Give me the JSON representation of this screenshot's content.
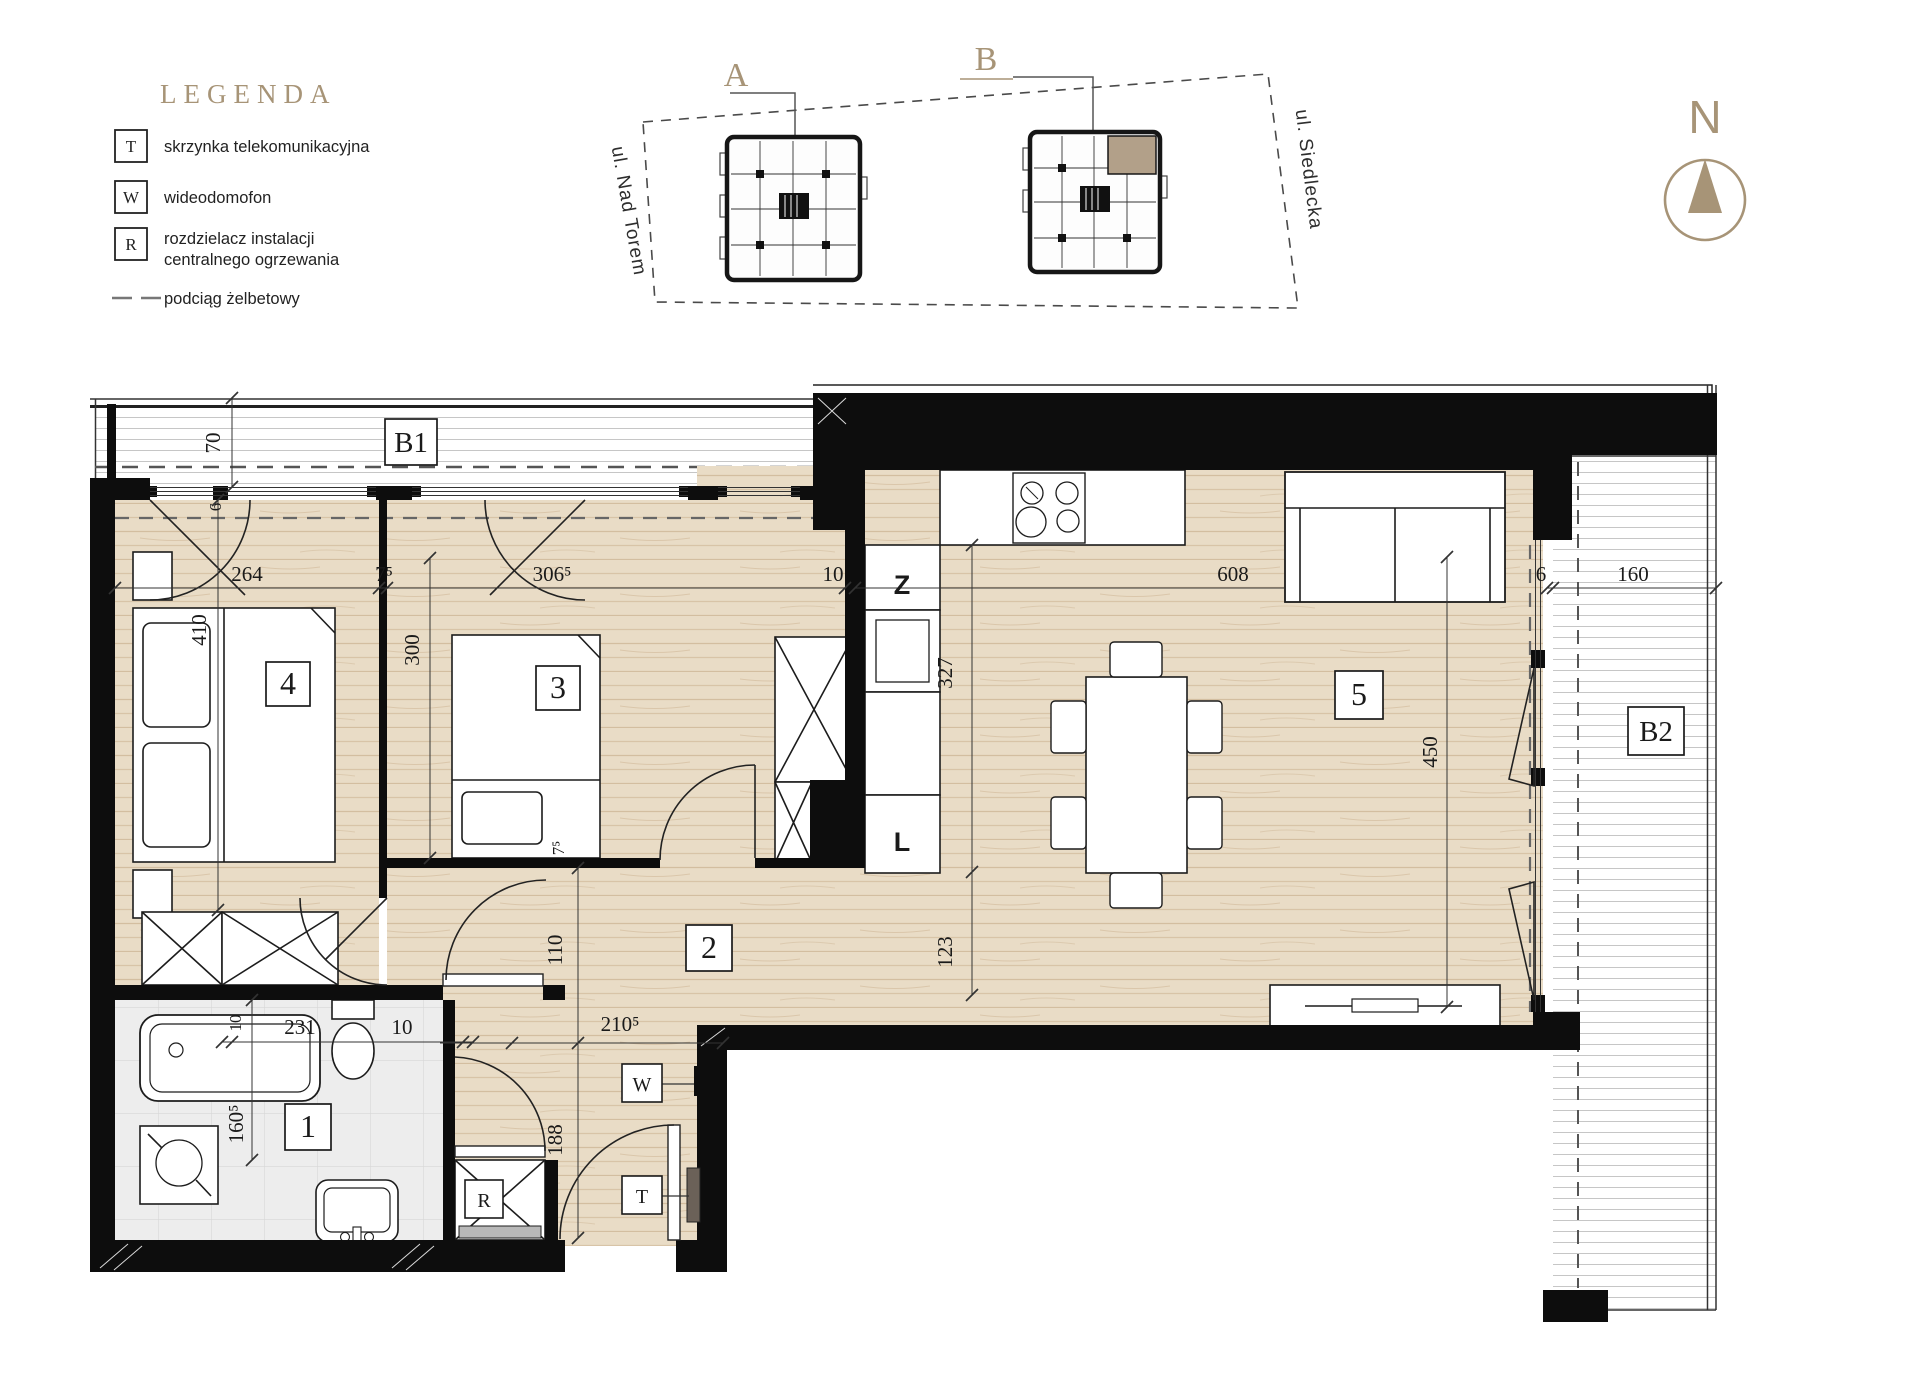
{
  "legend": {
    "title": "LEGENDA",
    "items": [
      {
        "symbol": "T",
        "label": "skrzynka telekomunikacyjna"
      },
      {
        "symbol": "W",
        "label": "wideodomofon"
      },
      {
        "symbol": "R",
        "label": "rozdzielacz instalacji",
        "label2": "centralnego ogrzewania"
      },
      {
        "symbol": "dashed-line",
        "label": "podciąg żelbetowy"
      }
    ]
  },
  "site_plan": {
    "building_a": "A",
    "building_b": "B",
    "street_left": "ul. Nad Torem",
    "street_right": "ul. Siedlecka"
  },
  "compass": {
    "north": "N"
  },
  "rooms": {
    "r1": "1",
    "r2": "2",
    "r3": "3",
    "r4": "4",
    "r5": "5"
  },
  "balconies": {
    "b1": "B1",
    "b2": "B2"
  },
  "fixtures": {
    "z": "Z",
    "l": "L",
    "w": "W",
    "t": "T",
    "r": "R"
  },
  "dims": {
    "b1_depth": "70",
    "win6": "6",
    "top_264": "264",
    "top_75": "7⁵",
    "top_3065": "306⁵",
    "top_10": "10",
    "top_608": "608",
    "b2_6": "6",
    "b2_160": "160",
    "r4_410": "410",
    "r3_300": "300",
    "r3_75": "7⁵",
    "k_327": "327",
    "k_123": "123",
    "r5_450": "450",
    "h_110": "110",
    "h_2105": "210⁵",
    "h_188": "188",
    "bath_10a": "10",
    "bath_231": "231",
    "bath_10b": "10",
    "bath_1605": "160⁵"
  },
  "colors": {
    "accent_tan": "#a79477",
    "wood": "#e9dcc6",
    "wall": "#0d0d0d",
    "tile": "#ededed",
    "highlight_unit": "#b2a089"
  }
}
